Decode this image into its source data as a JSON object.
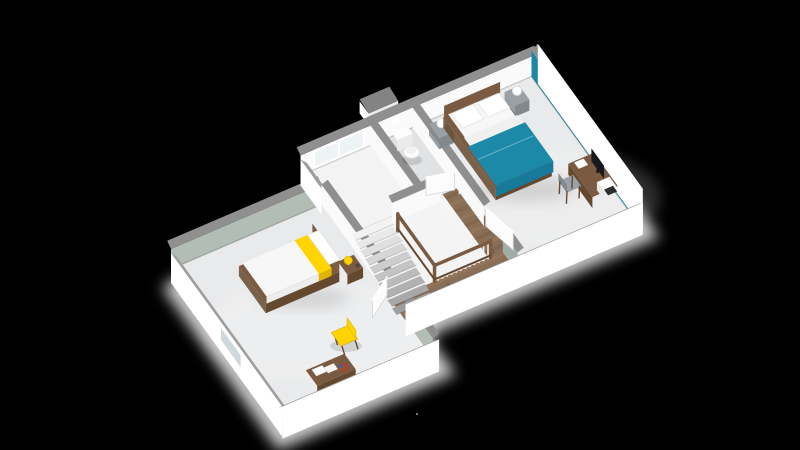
{
  "canvas": {
    "width": 800,
    "height": 450,
    "background": "#000000"
  },
  "scene": {
    "type": "3d-floorplan-render",
    "view": "isometric-from-south",
    "rooms": [
      {
        "name": "bedroom-secondary",
        "floor": "light-gray",
        "accent_wall": "sage"
      },
      {
        "name": "landing",
        "floor": "light-gray"
      },
      {
        "name": "wc",
        "floor": "light-gray"
      },
      {
        "name": "stair-hall",
        "floor": "wood-planks"
      },
      {
        "name": "bedroom-master",
        "floor": "light-gray",
        "accent_wall": "teal"
      }
    ],
    "furniture": {
      "bedroom-master": [
        "double-bed-teal-duvet",
        "nightstand-left",
        "ball-lamp-left",
        "nightstand-right",
        "ball-lamp-right",
        "desk",
        "monitor",
        "desk-chair",
        "dark-unit"
      ],
      "bedroom-secondary": [
        "single-bed-yellow-throw",
        "nightstand",
        "mushroom-lamp-yellow",
        "bench-desk",
        "papers",
        "toy-red-blue",
        "chair-yellow"
      ],
      "wc": [
        "toilet",
        "flush-plate"
      ],
      "stair-hall": [
        "staircase-down",
        "stair-railing-wood-white-balusters"
      ]
    },
    "openings": {
      "windows": [
        "landing-north-window",
        "bedroom-secondary-west-window",
        "bedroom-master-east-window"
      ],
      "doors": [
        "bedroom-secondary-door-open",
        "bedroom-master-door-open",
        "wc-door-ajar"
      ]
    },
    "exterior": [
      "gray-wall-caps",
      "white-fascia",
      "white-ground-glow",
      "chimney-stub"
    ]
  },
  "colors": {
    "background": "#000000",
    "cap": "#8f8f8f",
    "capLight": "#9e9e9e",
    "capDark": "#838383",
    "wallWhite": "#fafafa",
    "wallShade": "#ebebeb",
    "fascia": "#ffffff",
    "glow": "#ffffff",
    "sage": "#b2bdb5",
    "sageDark": "#9fafa8",
    "teal": "#1e87a8",
    "tealDark": "#166f8c",
    "floor": "#e9eaeb",
    "floorBright": "#f3f3f4",
    "wcFloor": "#e0e2e4",
    "voidFloor": "#f4f4f4",
    "woodFloor": "#8a6e55",
    "plankDark": "#755a43",
    "plankLight": "#a08565",
    "woodFurn": "#7a5b41",
    "woodFurnDark": "#65492f",
    "mattress": "#f7f7f7",
    "pillow": "#ffffff",
    "sheet": "#f0f0f0",
    "duvet": "#1d89a8",
    "duvetDark": "#177a99",
    "yellow": "#ffd400",
    "yellowDark": "#e0b400",
    "grayFurn": "#9aa1a6",
    "grayFurnDark": "#82898e",
    "monitor": "#17191c",
    "glass": "#cfd9dd",
    "glassBright": "#eef3f5",
    "frame": "#ffffff",
    "stairLight": "#f2f2f2",
    "stairDark": "#9f9f9f",
    "baluster": "#f3f3f3",
    "toilet": "#fdfdfd",
    "doorWhite": "#fcfcfc",
    "doorEdge": "#d6d6d6",
    "accentRed": "#c0392b",
    "accentBlue": "#2e5fbf",
    "speck": "#9a9aa2",
    "shadow": "rgba(0,0,0,0.12)"
  }
}
